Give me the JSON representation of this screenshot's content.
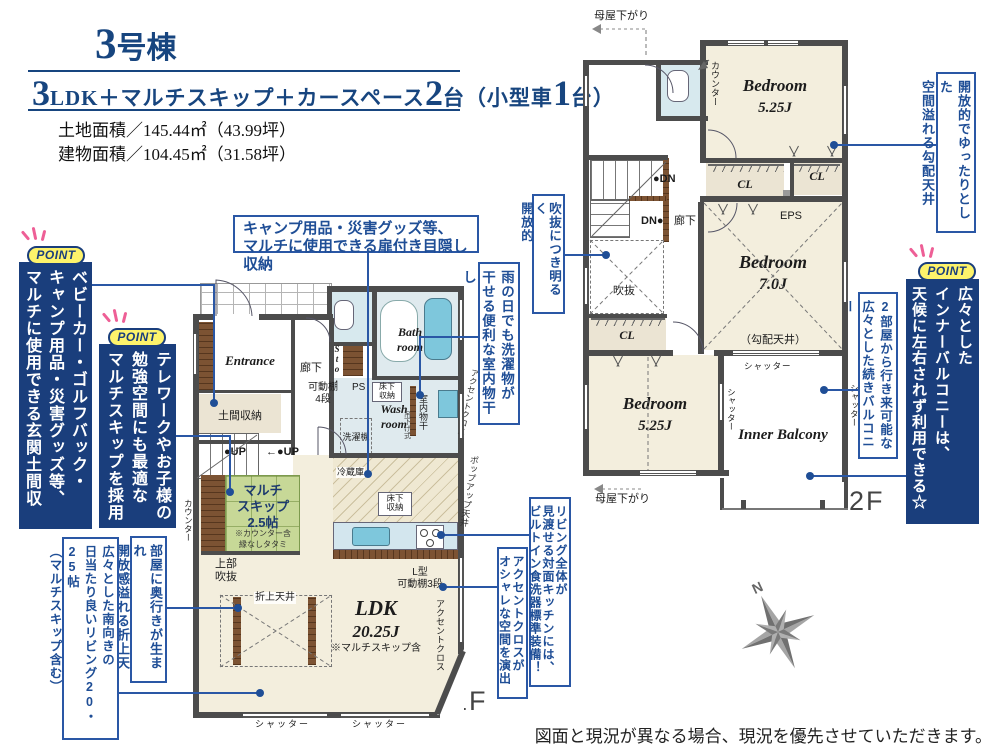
{
  "colors": {
    "navy": "#1a3e7c",
    "callout_blue": "#2a57a5",
    "text_blue": "#1f4e96",
    "header_blue": "#17457f",
    "badge_yellow": "#fdf36b",
    "ray_pink": "#ee5f96",
    "wall_gray": "#4c4c4c",
    "room_cream": "#f3eedd",
    "tatami_green": "#c7d897",
    "water_blue": "#7ec7dc",
    "wet_room_blue": "#dfeaee",
    "closet_beige": "#ebe4d3",
    "wood_brown": "#7c5333",
    "compass_gray": "#8a8a8a"
  },
  "header": {
    "building_no": "3号棟",
    "layout_parts": [
      "3",
      "LDK＋マルチスキップ＋カースペース",
      "2",
      "台（小型車",
      "1",
      "台）"
    ],
    "land_area": "土地面積／145.44㎡（43.99坪）",
    "building_area": "建物面積／104.45㎡（31.58坪）"
  },
  "badge_label": "POINT",
  "points": {
    "doma": "ベビーカー・ゴルフバック・\nキャンプ用品・災害グッズ等、\nマルチに使用できる玄関土間収納",
    "multiskip": "テレワークやお子様の\n勉強空間にも最適な\nマルチスキップを採用",
    "balcony": "広々とした\nインナーバルコニーは、\n天候に左右されず利用できる☆"
  },
  "callouts": {
    "hidden_storage": "キャンプ用品・災害グッズ等、\nマルチに使用できる扉付き目隠し収納",
    "indoor_drying": "雨の日でも洗濯物が\n干せる便利な室内物干し",
    "void_bright": "吹抜につき明るく\n開放的",
    "kitchen": "リビング全体が\n見渡せる対面キッチンには、\nビルトイン食洗器標準装備！",
    "accent_cloth": "アクセントクロスが\nオシャレな空間を演出",
    "coffered": "部屋に奥行きが生まれ\n開放感溢れる折上天井",
    "living": "広々とした南向きの\n日当たり良いリビング20・25帖\n（マルチスキップ含む）",
    "sloped_ceiling": "開放的でゆったりとした\n空間溢れる勾配天井",
    "tsuzuki_balcony": "2部屋から行き来可能な\n広々とした続きバルコニー"
  },
  "floor1": {
    "label": "1F",
    "entrance": "Entrance",
    "doma_storage": "土間収納",
    "hallway": "廊下",
    "movable_shelf": "可動棚\n4段",
    "sto": "Sto.",
    "ps": "PS",
    "bath": "Bath\nroom",
    "wash": "Wash\nroom",
    "underfloor_wash": "床下\n収納",
    "washer": "洗濯機",
    "drying_pole": "室内物干",
    "drying_type": "吊下げ式",
    "accent_cloth1": "アクセントクロス",
    "popup_ceiling": "ポップアップ天井",
    "up1": "●UP",
    "up2": "←●UP",
    "multiskip": "マルチ\nスキップ\n2.5帖",
    "multiskip_note1": "※カウンター含",
    "multiskip_note2": "縁なしタタミ",
    "counter": "カウンター",
    "open_above": "上部\n吹抜",
    "fridge": "冷蔵庫",
    "underfloor_kitchen": "床下\n収納",
    "l_shelf": "L型\n可動棚3段",
    "accent_cloth2": "アクセントクロス",
    "coffered_ceiling": "折上天井",
    "ldk_name": "LDK",
    "ldk_size": "20.25J",
    "ldk_note": "※マルチスキップ含",
    "shutter1": "シャッター",
    "shutter2": "シャッター"
  },
  "floor2": {
    "label": "2F",
    "moya_top": "母屋下がり",
    "moya_bottom": "母屋下がり",
    "counter": "カウンター",
    "bedroom1_name": "Bedroom",
    "bedroom1_size": "5.25J",
    "cl1": "CL",
    "cl2": "CL",
    "cl3": "CL",
    "eps": "EPS",
    "dn1": "●DN",
    "dn2": "DN●",
    "hallway": "廊下",
    "void": "吹抜",
    "bedroom2_name": "Bedroom",
    "bedroom2_size": "7.0J",
    "bedroom2_note": "（勾配天井）",
    "bedroom3_name": "Bedroom",
    "bedroom3_size": "5.25J",
    "balcony_name": "Inner Balcony",
    "shutter_top": "シャッター",
    "shutter_left": "シャッター",
    "shutter_right": "シャッター"
  },
  "compass": {
    "north_label": "N"
  },
  "disclaimer": "図面と現況が異なる場合、現況を優先させていただきます。"
}
